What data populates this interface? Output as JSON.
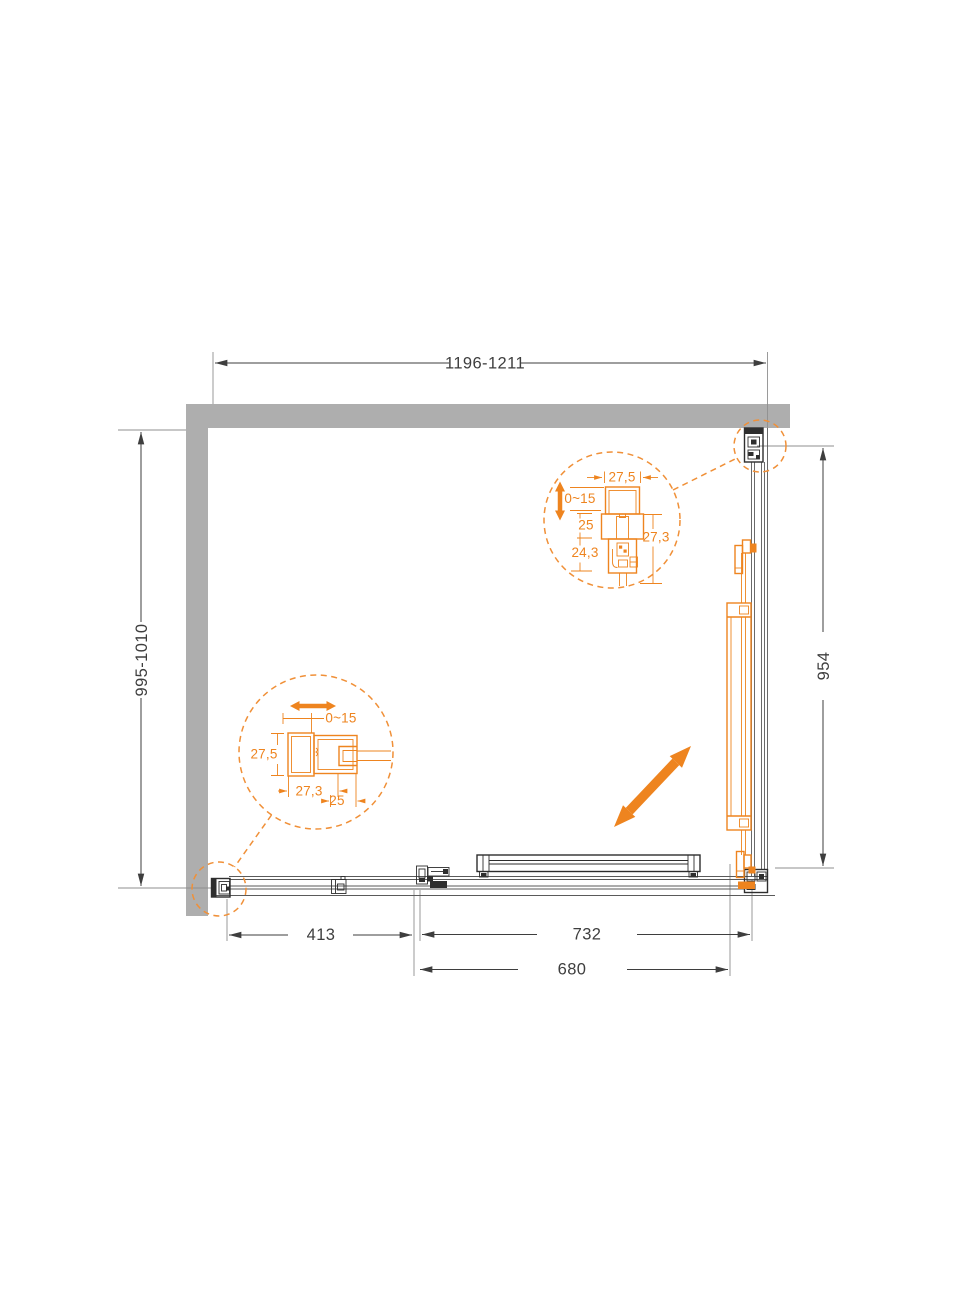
{
  "diagram": {
    "type": "shower-enclosure-plan-top-view",
    "colors": {
      "accent_orange": "#EE841F",
      "accent_orange_light": "#F09038",
      "wall_gray": "#AEAEAE",
      "line_dark": "#3E3E3E",
      "background": "#FFFFFF"
    },
    "main_dimensions": {
      "top": "1196-1211",
      "left": "995-1010",
      "right": "954",
      "bottom_fixed": "413",
      "bottom_total": "732",
      "bottom_entry": "680"
    },
    "detail_top_profile": {
      "width": "27,5",
      "adjustment": "0~15",
      "dim_a": "25",
      "dim_b": "24,3",
      "dim_c": "27,3"
    },
    "detail_side_profile": {
      "adjustment": "0~15",
      "height": "27,5",
      "width": "27,3",
      "overlap": "25"
    }
  }
}
